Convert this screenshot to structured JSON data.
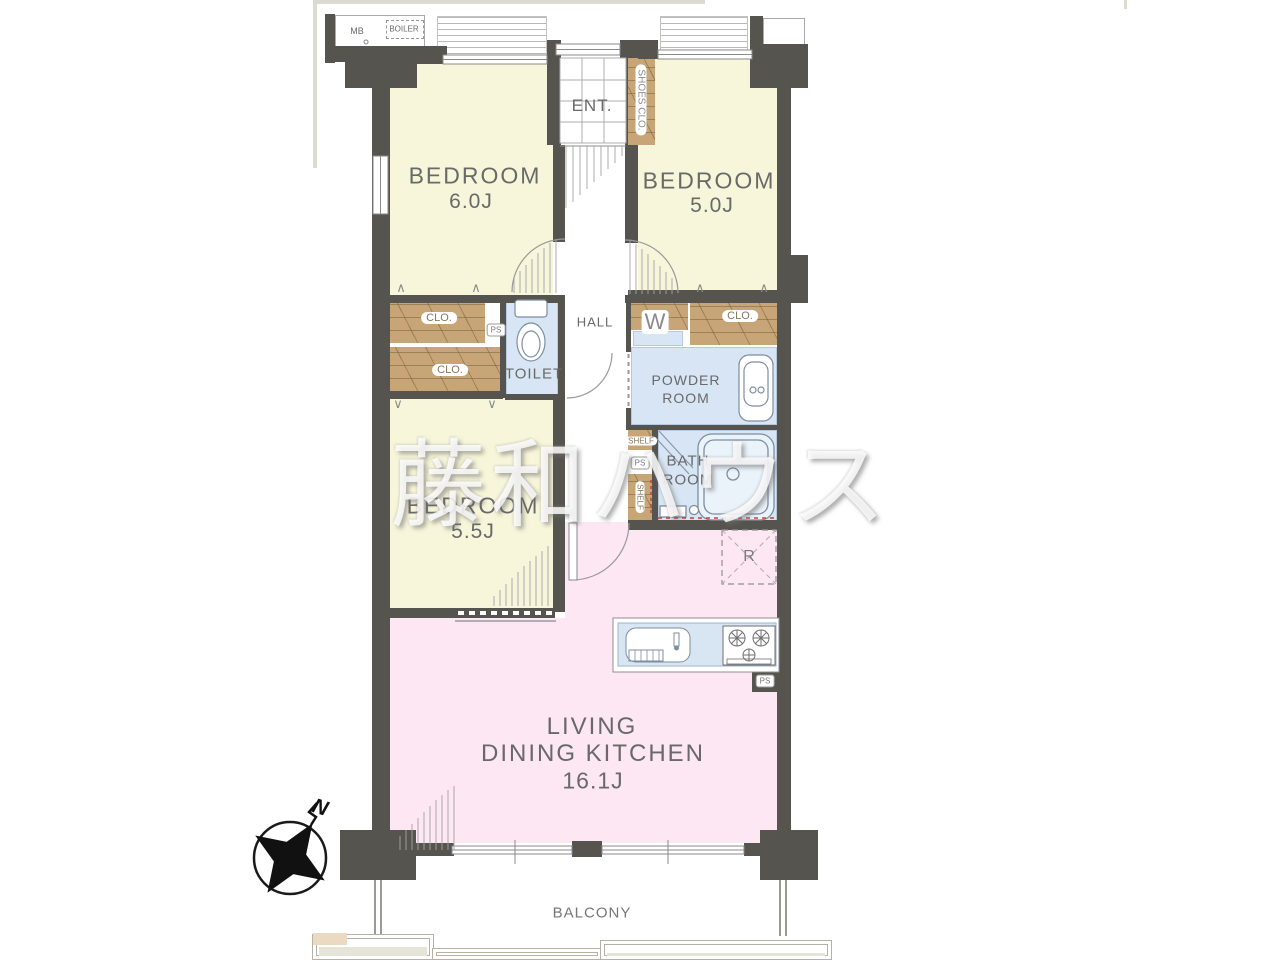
{
  "watermark": "藤和ハウス",
  "compass": {
    "north": "N"
  },
  "meter_box": {
    "mb": "MB",
    "boiler": "BOILER"
  },
  "entrance": {
    "label": "ENT.",
    "shoes_closet": "SHOES CLO."
  },
  "rooms": {
    "bedroom_a": {
      "name": "BEDROOM",
      "size": "6.0J"
    },
    "bedroom_b": {
      "name": "BEDROOM",
      "size": "5.0J"
    },
    "bedroom_c": {
      "name": "BEDROOM",
      "size": "5.5J"
    },
    "ldk": {
      "line1": "LIVING",
      "line2": "DINING KITCHEN",
      "size": "16.1J"
    },
    "hall": {
      "label": "HALL"
    },
    "toilet": {
      "label": "TOILET"
    },
    "powder_room": {
      "line1": "POWDER",
      "line2": "ROOM"
    },
    "bath_room": {
      "line1": "BATH",
      "line2": "ROOM"
    },
    "balcony": {
      "label": "BALCONY"
    }
  },
  "storage": {
    "closet": "CLO.",
    "shelf": "SHELF"
  },
  "appliances": {
    "washer": "W",
    "refrigerator": "R"
  },
  "shafts": {
    "ps": "PS"
  }
}
